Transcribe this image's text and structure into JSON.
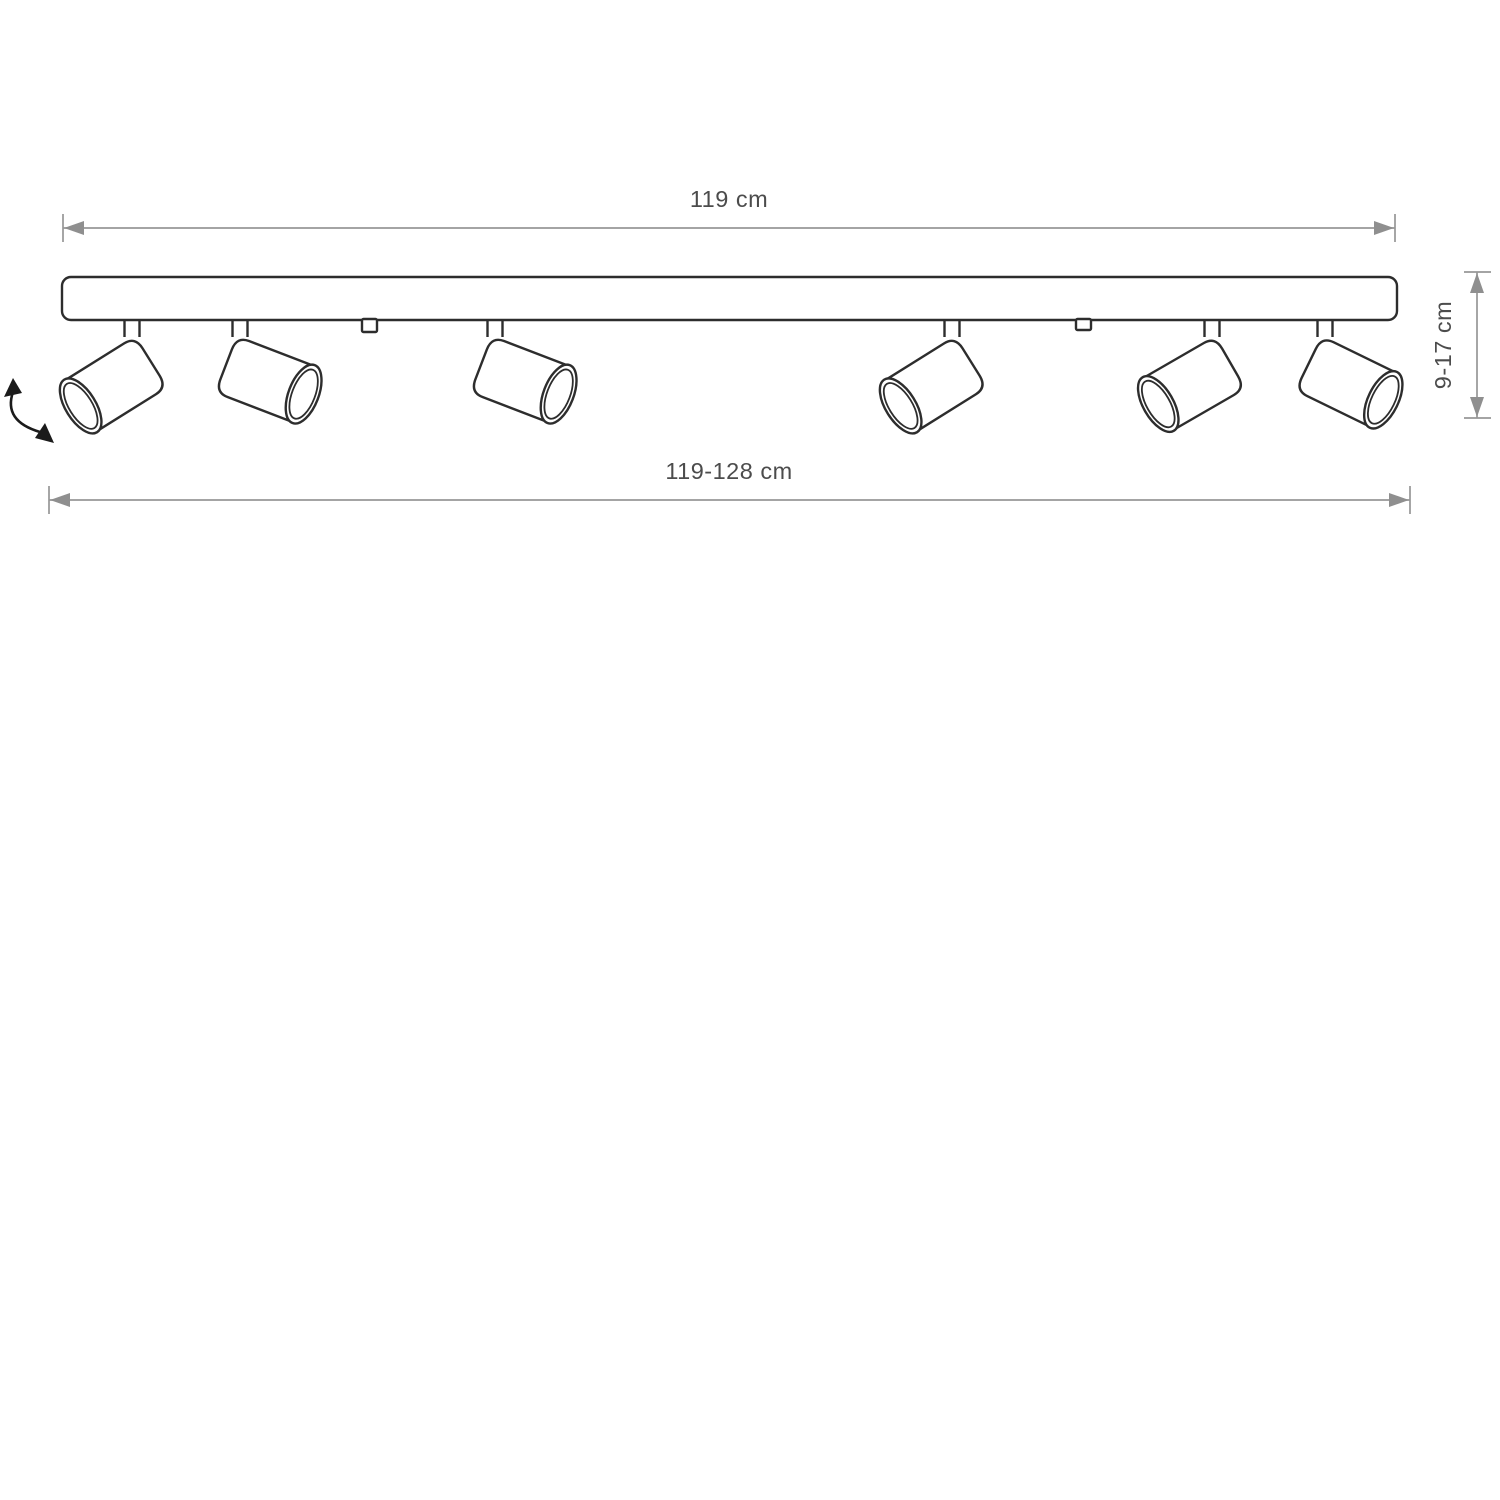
{
  "drawing": {
    "labels": {
      "top_width": "119 cm",
      "bottom_width": "119-128 cm",
      "height": "9-17 cm"
    },
    "spotlight_count": 6,
    "mounting_tab_count": 2,
    "colors": {
      "outline": "#2d2d2d",
      "dimension_line": "#979797",
      "label_text": "#4c4c4c",
      "rotation_arrow": "#1b1b1b",
      "background": "#ffffff"
    }
  }
}
